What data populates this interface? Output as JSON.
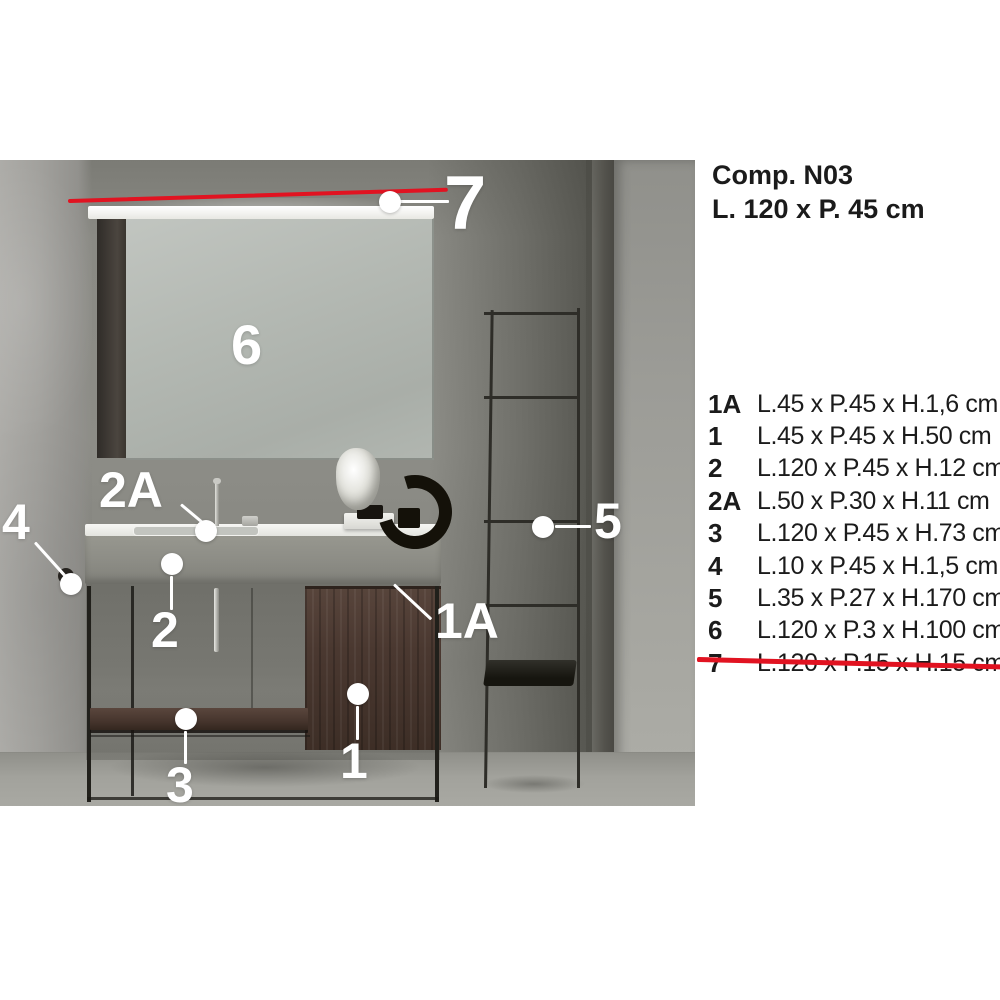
{
  "header": {
    "title_line1": "Comp. N03",
    "title_line2": "L. 120 x P. 45 cm"
  },
  "legend": {
    "rows": [
      {
        "num": "1A",
        "dims": "L.45 x P.45 x H.1,6 cm",
        "struck": false
      },
      {
        "num": "1",
        "dims": "L.45 x P.45 x H.50 cm",
        "struck": false
      },
      {
        "num": "2",
        "dims": "L.120 x P.45 x H.12 cm",
        "struck": false
      },
      {
        "num": "2A",
        "dims": "L.50 x P.30 x H.11 cm",
        "struck": false
      },
      {
        "num": "3",
        "dims": "L.120 x P.45 x H.73 cm",
        "struck": false
      },
      {
        "num": "4",
        "dims": "L.10 x P.45 x H.1,5 cm",
        "struck": false
      },
      {
        "num": "5",
        "dims": "L.35 x P.27 x H.170 cm",
        "struck": false
      },
      {
        "num": "6",
        "dims": "L.120 x P.3 x H.100 cm",
        "struck": false
      },
      {
        "num": "7",
        "dims": "L.120 x P.15 x H.15 cm",
        "struck": true
      }
    ]
  },
  "markers": {
    "m1": {
      "label": "1"
    },
    "m1A": {
      "label": "1A"
    },
    "m2": {
      "label": "2"
    },
    "m2A": {
      "label": "2A"
    },
    "m3": {
      "label": "3"
    },
    "m4": {
      "label": "4"
    },
    "m5": {
      "label": "5"
    },
    "m6": {
      "label": "6"
    },
    "m7": {
      "label": "7"
    }
  },
  "colors": {
    "accent_red": "#e11321",
    "text": "#1b1b1b",
    "marker_white": "#ffffff"
  }
}
